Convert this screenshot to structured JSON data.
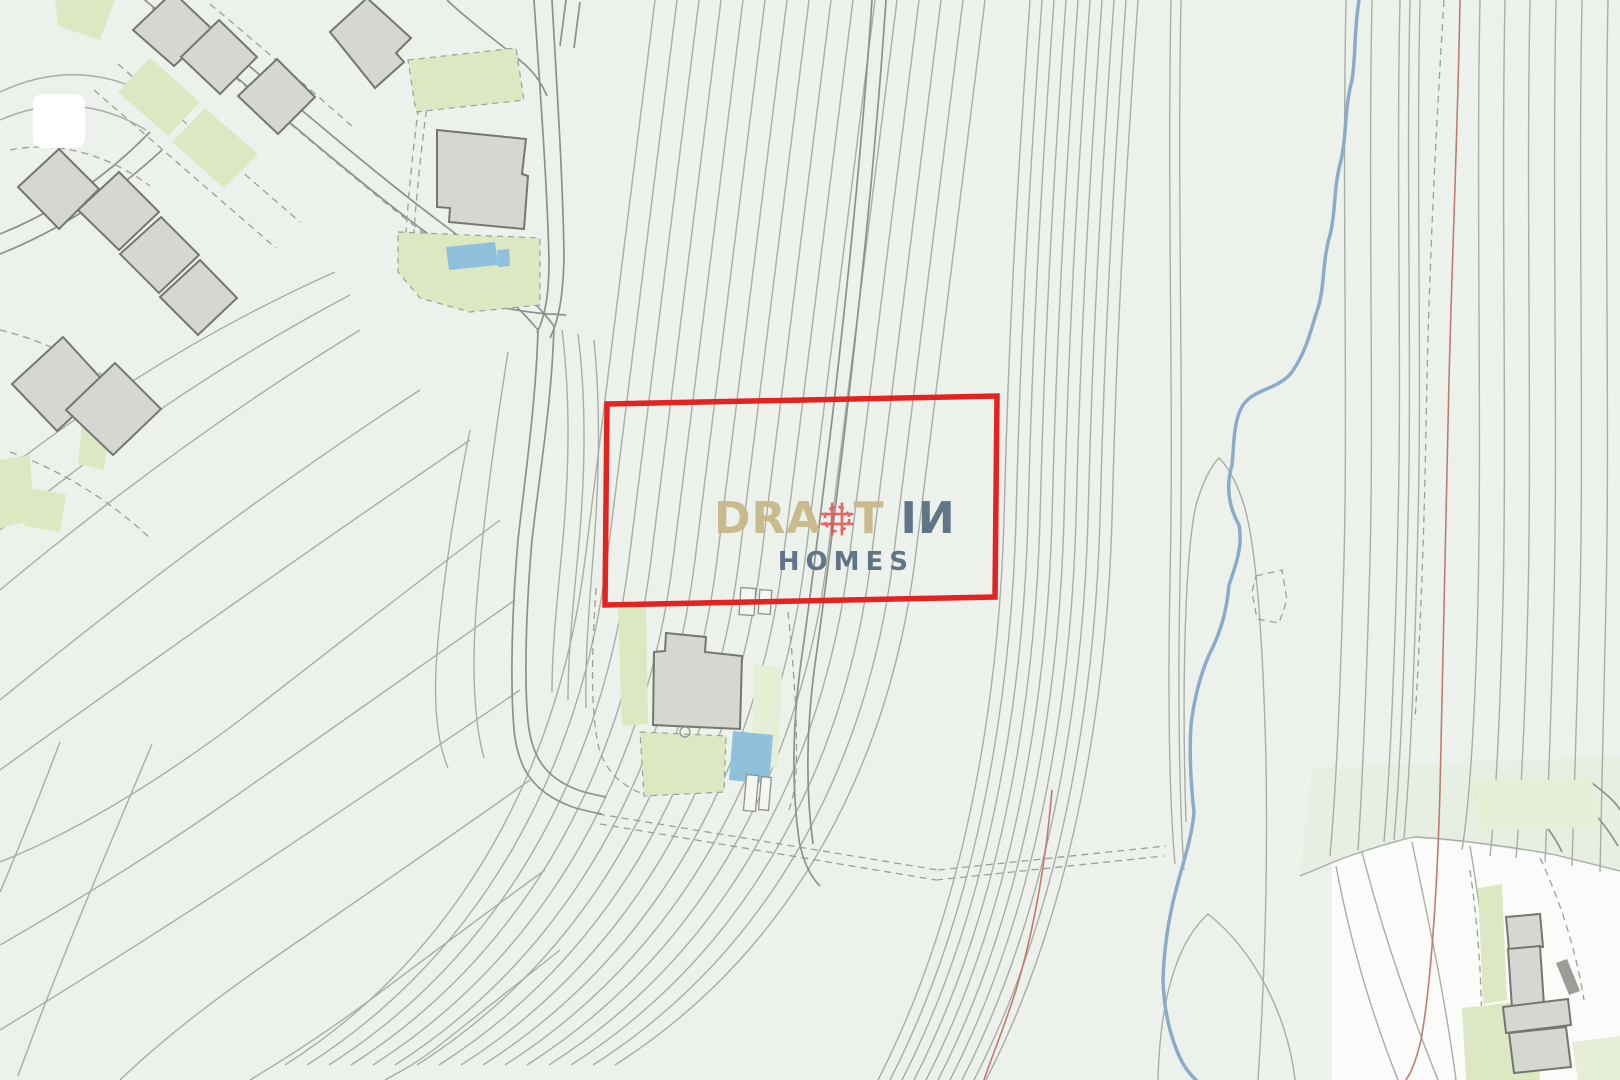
{
  "watermark": {
    "part1": "DRA",
    "part2": "T",
    "mark": "\\",
    "part3": "IИ",
    "sub": "HOMES"
  },
  "colors": {
    "bg": "#edf1ec",
    "bg-white": "#fbfcf9",
    "bg-green-tint": "#e7efe2",
    "contour": "#a9ada6",
    "contour-dark": "#8e918b",
    "dashed": "#9aa099",
    "lawn": "#dce8c2",
    "lawn-pale": "#e6eed6",
    "building-fill": "#d6d7d2",
    "building-stroke": "#75776f",
    "pool": "#8fc0dc",
    "stream": "#8aaccb",
    "redline": "#c07a70",
    "boundary-red": "#e32222",
    "logo-tan": "#c9b98c",
    "logo-slate": "#5b7084",
    "logo-red": "#e05252",
    "white-marker": "#ffffff"
  }
}
